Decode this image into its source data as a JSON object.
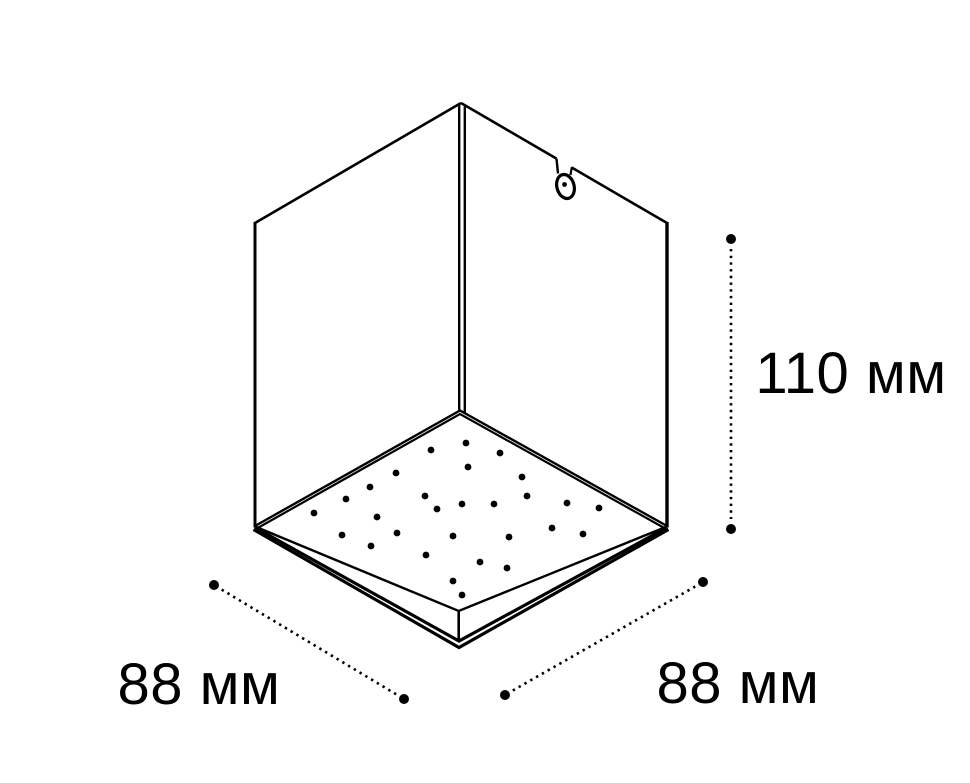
{
  "figure": {
    "type": "technical-dimension-drawing",
    "subject": "cube-shaped surface-mounted LED downlight viewed from below",
    "background_color": "#ffffff",
    "line_color": "#000000",
    "text_color": "#000000"
  },
  "dimensions": {
    "width_left_label": "88 мм",
    "width_right_label": "88 мм",
    "height_label": "110 мм"
  },
  "led_dots": [
    [
      431,
      450
    ],
    [
      466,
      443
    ],
    [
      396,
      473
    ],
    [
      500,
      453
    ],
    [
      370,
      487
    ],
    [
      468,
      467
    ],
    [
      346,
      499
    ],
    [
      522,
      477
    ],
    [
      314,
      513
    ],
    [
      425,
      496
    ],
    [
      437,
      509
    ],
    [
      462,
      504
    ],
    [
      494,
      504
    ],
    [
      527,
      496
    ],
    [
      567,
      503
    ],
    [
      599,
      508
    ],
    [
      377,
      517
    ],
    [
      342,
      535
    ],
    [
      397,
      533
    ],
    [
      453,
      536
    ],
    [
      509,
      537
    ],
    [
      552,
      528
    ],
    [
      583,
      534
    ],
    [
      371,
      546
    ],
    [
      426,
      555
    ],
    [
      480,
      562
    ],
    [
      507,
      568
    ],
    [
      453,
      581
    ],
    [
      462,
      595
    ]
  ],
  "led_dot_radius": 3.4
}
